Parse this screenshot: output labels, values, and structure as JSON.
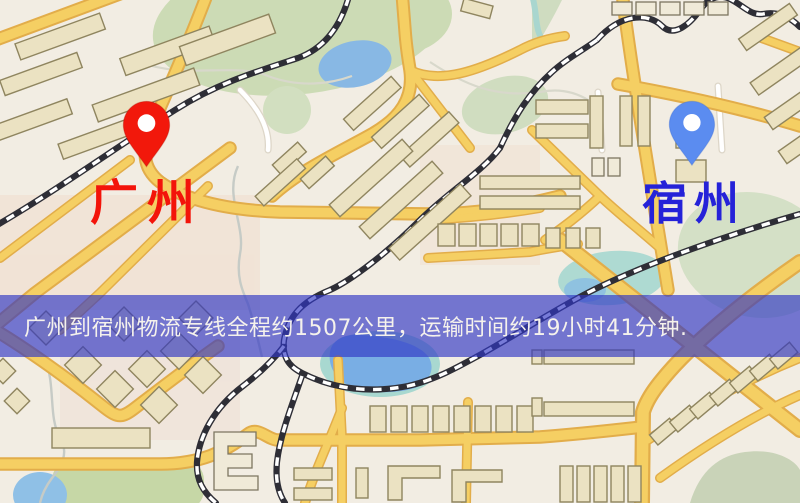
{
  "window": {
    "width": 800,
    "height": 503,
    "kind": "logistics-route-map"
  },
  "map": {
    "origin": {
      "name": "广州",
      "label_color": "#f3140a",
      "pin_color": "#f2180b",
      "pin_icon": "red-map-pin"
    },
    "destination": {
      "name": "宿州",
      "label_color": "#2522d8",
      "pin_color": "#5b8cf0",
      "pin_icon": "blue-map-pin"
    }
  },
  "banner": {
    "text": "广州到宿州物流专线全程约1507公里，运输时间约19小时41分钟.",
    "distance_km": 1507,
    "duration_text": "19小时41分钟",
    "background_color": "#3036c4",
    "text_color": "#f5f2ec"
  },
  "palette": {
    "map_background": "#f2ede3",
    "road_fill": "#f5cf63",
    "road_casing": "#e2ad4a",
    "minor_road": "#ffffff",
    "building_fill": "#ebe2c2",
    "building_outline": "#8f855f",
    "park_green": "#ccdbb5",
    "water_blue": "#88b8e4",
    "water_teal": "#a8d8d0",
    "railway_dark": "#2e2e36",
    "railway_light": "#ffffff"
  }
}
